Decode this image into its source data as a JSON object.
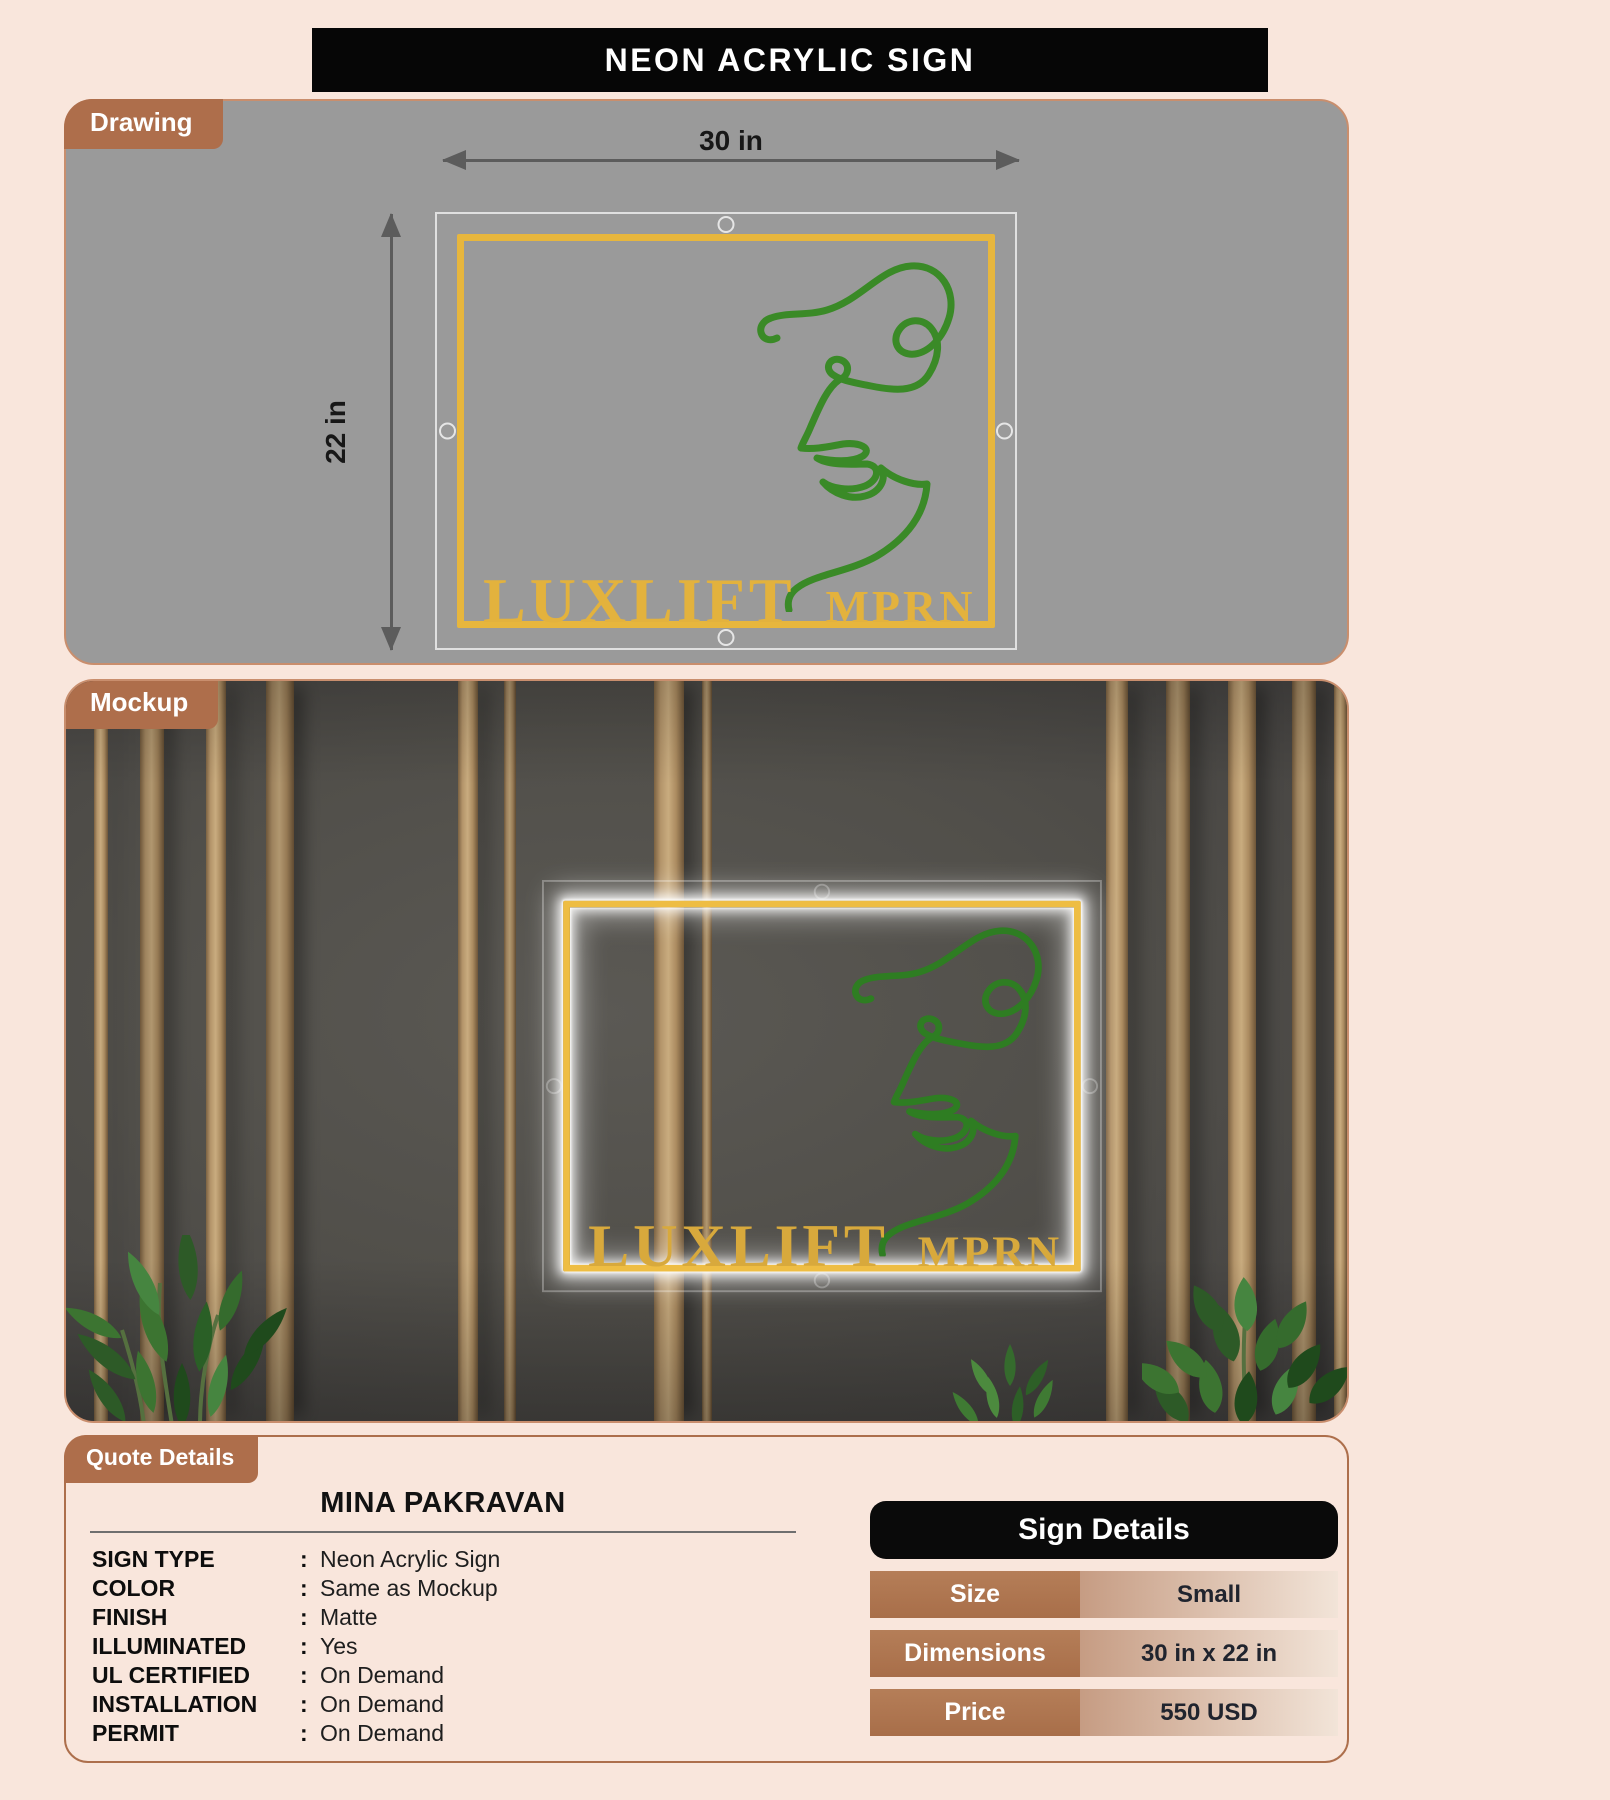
{
  "page": {
    "title": "NEON ACRYLIC SIGN"
  },
  "drawing": {
    "tab": "Drawing",
    "width_label": "30 in",
    "height_label": "22 in"
  },
  "mockup": {
    "tab": "Mockup"
  },
  "sign": {
    "brand": "LUXLIFT",
    "sub": "MPRN"
  },
  "quote": {
    "tab": "Quote Details",
    "customer": "MINA PAKRAVAN",
    "colon": ":",
    "rows": [
      {
        "label": "SIGN TYPE",
        "value": "Neon Acrylic Sign"
      },
      {
        "label": "COLOR",
        "value": "Same as Mockup"
      },
      {
        "label": "FINISH",
        "value": "Matte"
      },
      {
        "label": "ILLUMINATED",
        "value": "Yes"
      },
      {
        "label": "UL CERTIFIED",
        "value": "On Demand"
      },
      {
        "label": "INSTALLATION",
        "value": "On Demand"
      },
      {
        "label": "PERMIT",
        "value": "On Demand"
      }
    ]
  },
  "sign_details": {
    "title": "Sign Details",
    "rows": [
      {
        "label": "Size",
        "value": "Small"
      },
      {
        "label": "Dimensions",
        "value": "30 in x 22 in"
      },
      {
        "label": "Price",
        "value": "550 USD"
      }
    ]
  },
  "colors": {
    "accent_brown": "#ae6e4b",
    "neon_yellow": "#e7b63d",
    "line_green": "#3a8a27",
    "banner_black": "#060606",
    "page_background": "#f9e6dc"
  }
}
